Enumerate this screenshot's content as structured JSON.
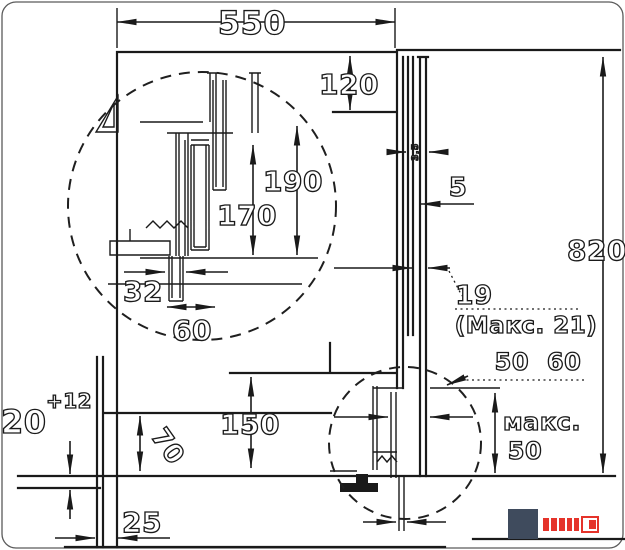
{
  "dims": {
    "niche_width": "550",
    "top_clearance": "120",
    "hose_height_max": "190",
    "hose_height_min": "170",
    "drain_outlet_width": "32",
    "drain_outlet_diameter": "60",
    "rear_gap": "5",
    "total_height": "820",
    "bracket_gap": "19",
    "bracket_gap_max": "(Макс. 21)",
    "fastener_range": "50 60",
    "max_word": "макс.",
    "max_value": "50",
    "pump_height": "150",
    "bottom_clearance": "70",
    "feet_height": "20",
    "feet_adjust": "+12",
    "plinth_recess": "25",
    "panel_gap": "3,5"
  },
  "logo": {
    "square_color": "#3f4b5d",
    "accent_color": "#e5332a"
  },
  "colors": {
    "line": "#1a1a1a",
    "background": "#ffffff"
  }
}
